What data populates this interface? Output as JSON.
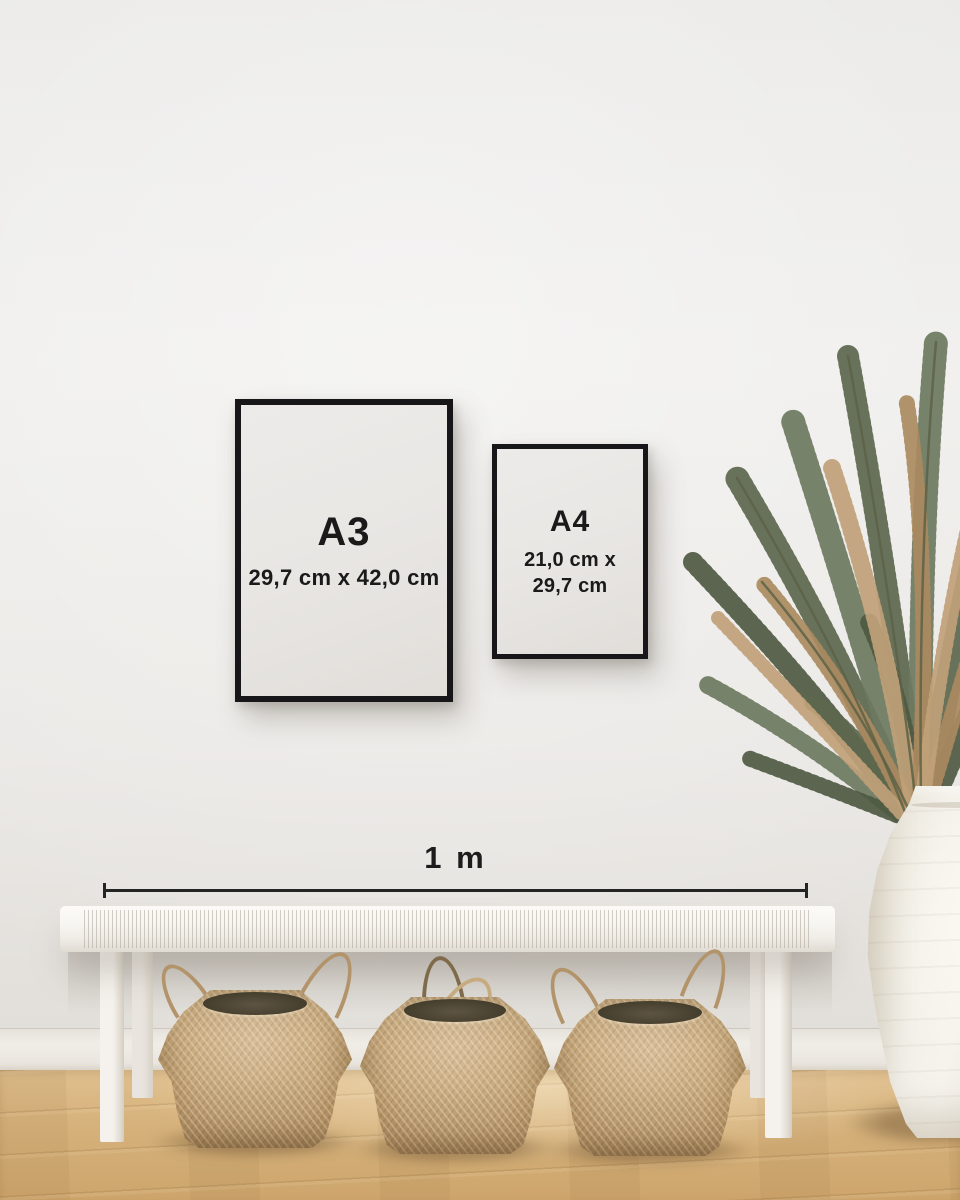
{
  "frames": [
    {
      "label": "A3",
      "dimensions": "29,7 cm x 42,0 cm"
    },
    {
      "label": "A4",
      "dimensions_line1": "21,0 cm x",
      "dimensions_line2": "29,7 cm"
    }
  ],
  "scale_bar": {
    "label": "1 m"
  },
  "colors": {
    "wall": "#edecea",
    "baseboard": "#eceae4",
    "floor_wood": "#d5ae76",
    "frame_border": "#17171a",
    "frame_paper": "#e9e7e4",
    "text": "#1a1a1a",
    "measure_line": "#242424",
    "bench_white": "#f6f4f0",
    "basket_tan": "#c4a376",
    "basket_opening": "#4a4231",
    "vase_white": "#f2efe8",
    "plant_green": "#5c674e",
    "plant_brown": "#aa8a5f"
  }
}
